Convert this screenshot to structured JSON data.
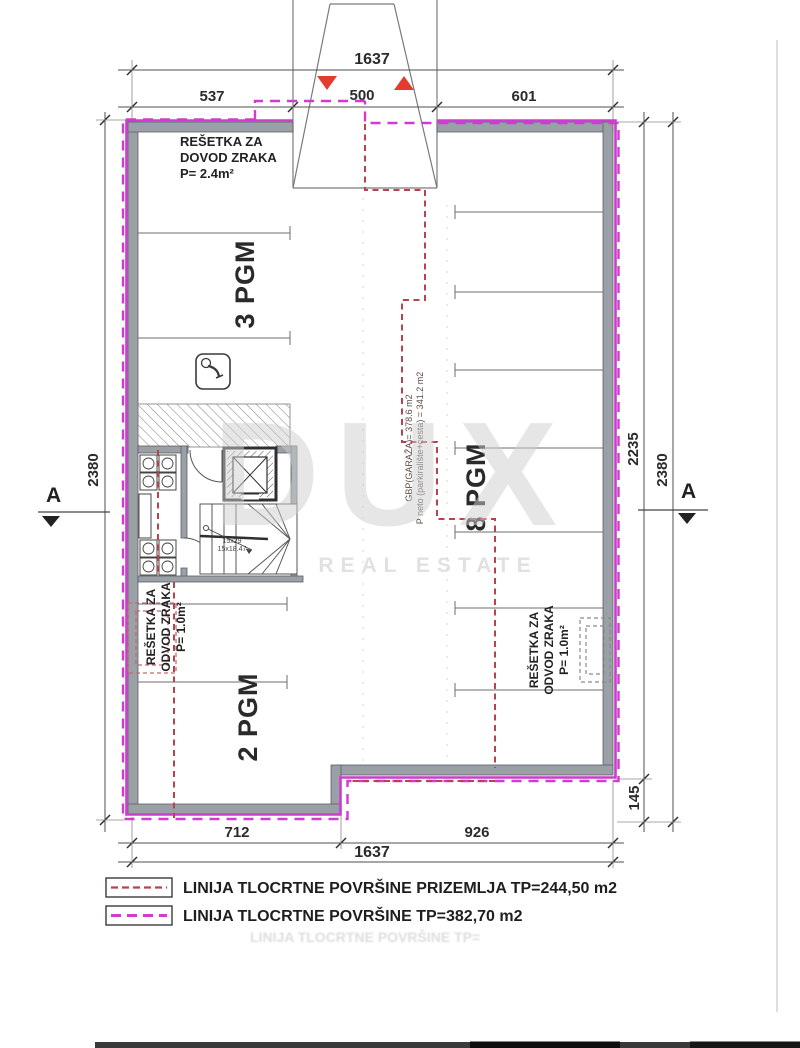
{
  "plan": {
    "rooms": {
      "pgm3_label": "3 PGM",
      "pgm8_label": "8 PGM",
      "pgm2_label": "2 PGM"
    },
    "notes": {
      "dovod_lines": [
        "REŠETKA ZA",
        "DOVOD ZRAKA",
        "P= 2.4m²"
      ],
      "odvod_left_lines": [
        "REŠETKA ZA",
        "ODVOD ZRAKA",
        "P= 1.0m²"
      ],
      "odvod_right_lines": [
        "REŠETKA ZA",
        "ODVOD ZRAKA",
        "P= 1.0m²"
      ],
      "gbp_lines": [
        "GBP(GARAŽA)= 378.6 m2",
        "P neto (parkiralište+cesta) = 341.2 m2"
      ],
      "stair_lines": [
        "15x29",
        "15x18.47"
      ]
    },
    "section_marker": "A"
  },
  "dimensions": {
    "top_total": "1637",
    "top_left": "537",
    "top_mid": "500",
    "top_right": "601",
    "left_height": "2380",
    "right_inner": "2235",
    "right_outer": "2380",
    "right_step": "145",
    "bottom_left": "712",
    "bottom_right": "926",
    "bottom_total": "1637"
  },
  "legend": {
    "row1": "LINIJA TLOCRTNE POVRŠINE PRIZEMLJA  TP=244,50 m2",
    "row2": "LINIJA TLOCRTNE POVRŠINE  TP=382,70 m2",
    "ghost": "LINIJA TLOCRTNE POVRŠINE  TP="
  },
  "watermark": {
    "brand": "DUX",
    "tagline": "REAL ESTATE"
  },
  "colors": {
    "outline_magenta": "#cb3ecd",
    "dash_red": "#b8434e",
    "wall_grey": "#9aa0a6",
    "triangle_red": "#e23c2e"
  }
}
